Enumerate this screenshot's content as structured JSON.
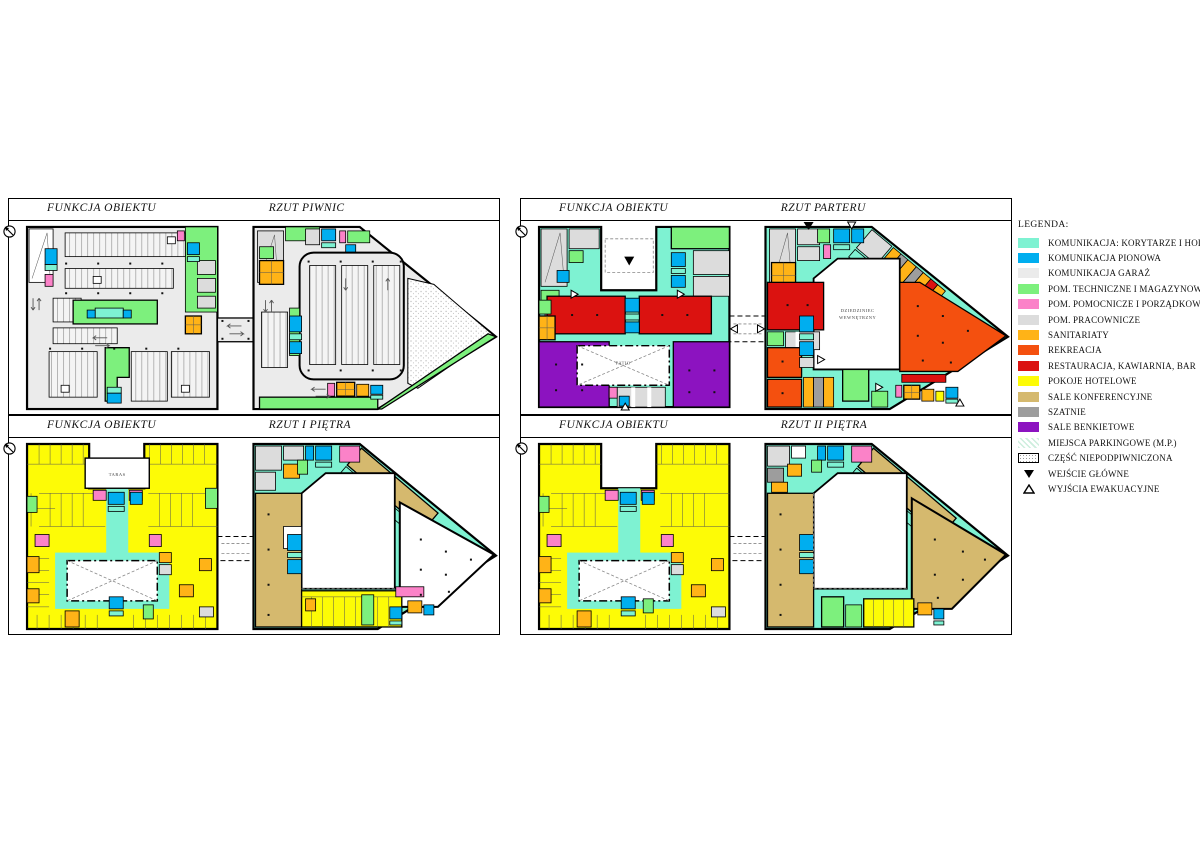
{
  "colors": {
    "aqua": "#7EF2D2",
    "blue": "#00AEEF",
    "garage": "#EBEBEB",
    "green": "#7DF07D",
    "pink": "#FB82C8",
    "workgray": "#DCDCDC",
    "amber": "#FFB317",
    "recreation": "#F4500F",
    "red": "#DB1210",
    "yellow": "#FDFB06",
    "tan": "#D5B96E",
    "gray": "#9D9D9D",
    "purple": "#8C13C0",
    "ink": "#000000",
    "paper": "#FFFFFF"
  },
  "panels": [
    {
      "function_label": "FUNKCJA OBIEKTU",
      "title": "RZUT PIWNIC"
    },
    {
      "function_label": "FUNKCJA OBIEKTU",
      "title": "RZUT PARTERU",
      "labels": {
        "patio": "PATIO",
        "courtyard_line1": "DZIEDZINIEC",
        "courtyard_line2": "WEWNĘTRZNY"
      }
    },
    {
      "function_label": "FUNKCJA OBIEKTU",
      "title": "RZUT I PIĘTRA",
      "labels": {
        "taras": "TARAS"
      }
    },
    {
      "function_label": "FUNKCJA OBIEKTU",
      "title": "RZUT II PIĘTRA"
    }
  ],
  "legend": {
    "title": "LEGENDA:",
    "items": [
      {
        "label": "KOMUNIKACJA: KORYTARZE I HOL",
        "color": "#7EF2D2"
      },
      {
        "label": "KOMUNIKACJA PIONOWA",
        "color": "#00AEEF"
      },
      {
        "label": "KOMUNIKACJA GARAŻ",
        "color": "#EBEBEB"
      },
      {
        "label": "POM. TECHNICZNE I MAGAZYNOWE",
        "color": "#7DF07D"
      },
      {
        "label": "POM. POMOCNICZE I PORZĄDKOWE",
        "color": "#FB82C8"
      },
      {
        "label": "POM. PRACOWNICZE",
        "color": "#DCDCDC"
      },
      {
        "label": "SANITARIATY",
        "color": "#FFB317"
      },
      {
        "label": "REKREACJA",
        "color": "#F4500F"
      },
      {
        "label": "RESTAURACJA, KAWIARNIA, BAR",
        "color": "#DB1210"
      },
      {
        "label": "POKOJE HOTELOWE",
        "color": "#FDFB06"
      },
      {
        "label": "SALE KONFERENCYJNE",
        "color": "#D5B96E"
      },
      {
        "label": "SZATNIE",
        "color": "#9D9D9D"
      },
      {
        "label": "SALE BENKIETOWE",
        "color": "#8C13C0"
      },
      {
        "label": "MIEJSCA PARKINGOWE (M.P.)",
        "pattern": "pale-green-diagonal"
      },
      {
        "label": "CZĘŚĆ NIEPODPIWNICZONA",
        "pattern": "speckle-hatch"
      },
      {
        "label": "WEJŚCIE GŁÓWNE",
        "symbol": "filled-down-triangle"
      },
      {
        "label": "WYJŚCIA EWAKUACYJNE",
        "symbol": "open-up-triangle"
      }
    ]
  }
}
